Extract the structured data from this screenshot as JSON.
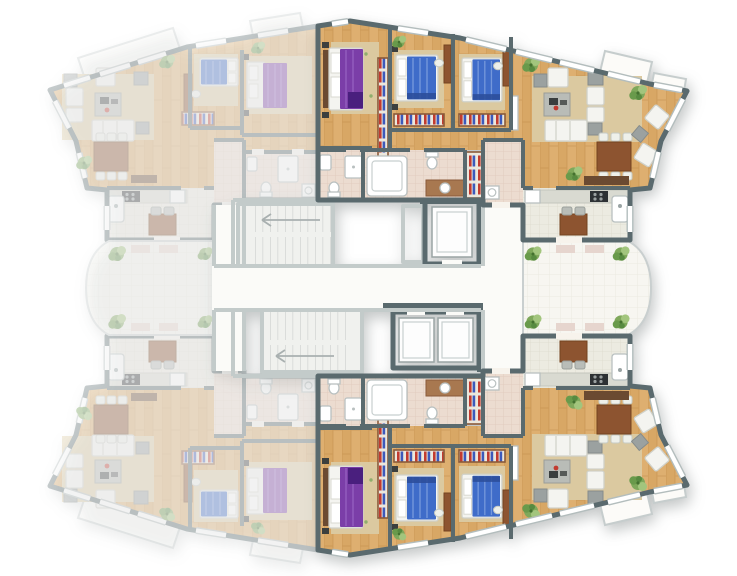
{
  "page": {
    "title": "Residential building floor plan — unit availability view"
  },
  "fade": 0.34,
  "colors": {
    "wall": "#5a6a6e",
    "wall_light": "#c3cbca",
    "wood": "#d8a765",
    "wood_seam": "#c08d4b",
    "rug": "#dbc9a0",
    "tile_pink": "#ecdcd0",
    "tile_kitchen": "#ecebe1",
    "terrace": "#f7f6f1",
    "corridor": "#fbfbf8",
    "stair_floor": "#f0f1ee",
    "purple_bed": "#7b3ea8",
    "purple_throw": "#4a1f7e",
    "blue_bed": "#3f6cc9",
    "blue_stripe": "#7e9fde",
    "red_accent": "#c23b30",
    "blue_accent": "#3c59bb",
    "sofa_white": "#f4f4f0",
    "gray_furniture": "#9ba1a0",
    "table_brown": "#8d5430",
    "sideboard_brown": "#6b4a31",
    "counter": "#d9dad1",
    "stove": "#2d3134",
    "plant_green": "#7fa85b",
    "mat": "#e6d5ce",
    "window_frame": "#b3bdbd"
  },
  "units": [
    {
      "id": "top-right",
      "state": "highlighted",
      "bedrooms": 3,
      "rooms": [
        "master-bedroom",
        "bedroom-2",
        "bedroom-3",
        "bathroom-1",
        "bathroom-2",
        "entry-hall",
        "living-dining-room",
        "kitchen",
        "balconies"
      ]
    },
    {
      "id": "bottom-right",
      "state": "highlighted",
      "bedrooms": 3,
      "rooms": [
        "master-bedroom",
        "bedroom-2",
        "bedroom-3",
        "bathroom-1",
        "bathroom-2",
        "entry-hall",
        "living-dining-room",
        "kitchen",
        "balconies"
      ]
    },
    {
      "id": "top-left",
      "state": "faded",
      "bedrooms": 2,
      "rooms": [
        "master-bedroom",
        "bedroom-2",
        "bathroom",
        "entry-hall",
        "living-dining-room",
        "kitchen",
        "terrace",
        "balcony"
      ]
    },
    {
      "id": "bottom-left",
      "state": "faded",
      "bedrooms": 2,
      "rooms": [
        "master-bedroom",
        "bedroom-2",
        "bathroom",
        "entry-hall",
        "living-dining-room",
        "kitchen",
        "terrace",
        "balcony"
      ]
    }
  ],
  "common_areas": {
    "stairwells": 2,
    "elevators": 3,
    "corridor": "central east-west",
    "shared_terraces": [
      "east curved terrace",
      "west curved terrace"
    ]
  }
}
